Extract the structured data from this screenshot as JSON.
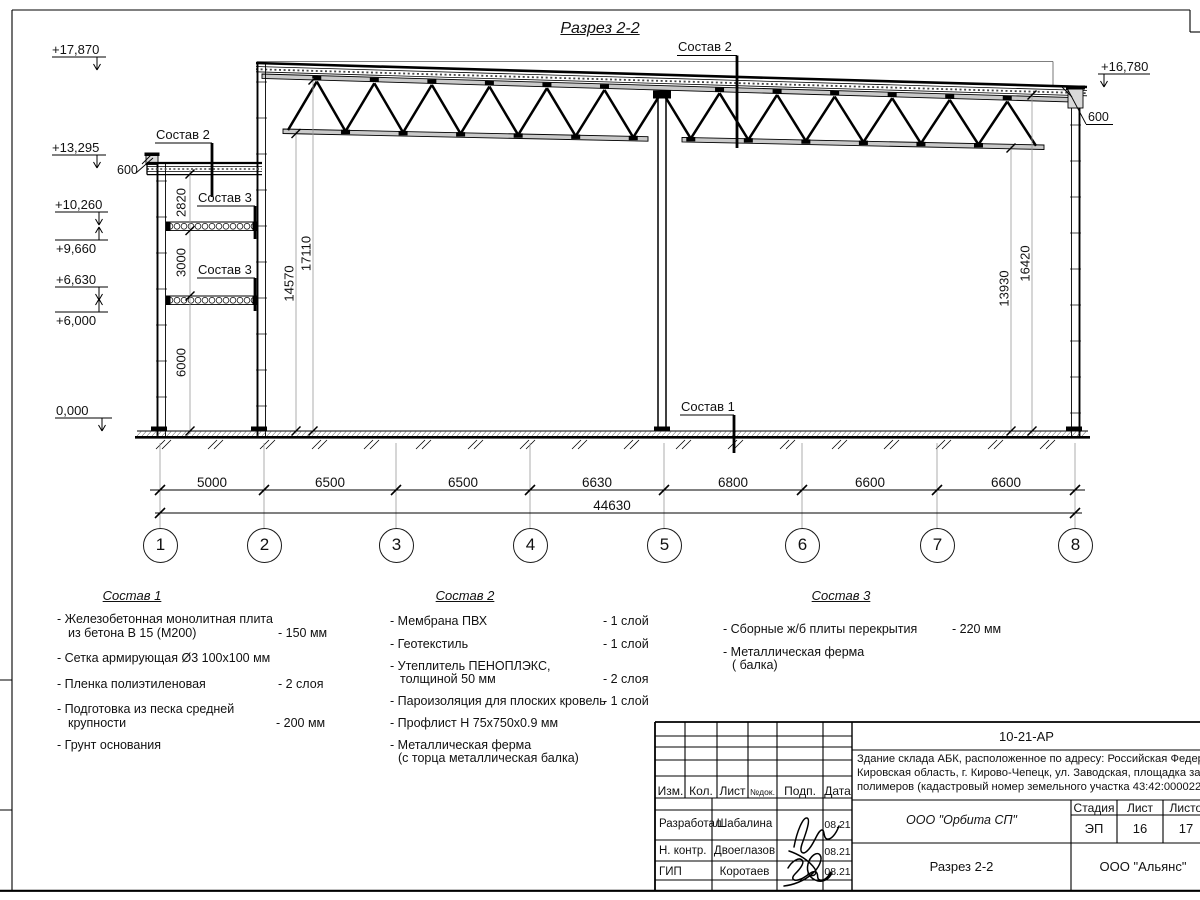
{
  "drawing": {
    "title": "Разрез 2-2",
    "callout_sostav_1": "Состав 1",
    "callout_sostav_2": "Состав 2",
    "callout_sostav_3": "Состав 3",
    "elevations": {
      "top_left": "+17,870",
      "annex_parapet": "+13,295",
      "level_10260": "+10,260",
      "level_9660": "+9,660",
      "level_6630": "+6,630",
      "level_6000": "+6,000",
      "ground": "0,000",
      "top_right": "+16,780"
    },
    "dims": {
      "parapet_left": "600",
      "parapet_right": "600",
      "annex_2820": "2820",
      "annex_3000": "3000",
      "annex_6000": "6000",
      "hall_left_clear": "14570",
      "hall_left_total": "17110",
      "hall_right_clear": "13930",
      "hall_right_total": "16420",
      "spans": [
        "5000",
        "6500",
        "6500",
        "6630",
        "6800",
        "6600",
        "6600"
      ],
      "total": "44630"
    },
    "axes": [
      "1",
      "2",
      "3",
      "4",
      "5",
      "6",
      "7",
      "8"
    ]
  },
  "legend_1": {
    "title": "Состав 1",
    "items": [
      {
        "t": "- Железобетонная  монолитная плита",
        "t2": "из бетона В 15 (М200)",
        "v": "- 150 мм"
      },
      {
        "t": "- Сетка армирующая Ø3 100х100 мм",
        "t2": "",
        "v": ""
      },
      {
        "t": "- Пленка полиэтиленовая",
        "t2": "",
        "v": "-  2 слоя"
      },
      {
        "t": "- Подготовка из песка средней",
        "t2": "крупности",
        "v": "- 200 мм"
      },
      {
        "t": "- Грунт основания",
        "t2": "",
        "v": ""
      }
    ]
  },
  "legend_2": {
    "title": "Состав 2",
    "items": [
      {
        "t": "- Мембрана ПВХ",
        "t2": "",
        "v": "- 1 слой"
      },
      {
        "t": "- Геотекстиль",
        "t2": "",
        "v": "- 1 слой"
      },
      {
        "t": "- Утеплитель ПЕНОПЛЭКС,",
        "t2": "толщиной 50 мм",
        "v": "- 2 слоя"
      },
      {
        "t": "- Пароизоляция для плоских кровель",
        "t2": "",
        "v": "- 1 слой"
      },
      {
        "t": "- Профлист Н 75х750х0.9 мм",
        "t2": "",
        "v": ""
      },
      {
        "t": "- Металлическая ферма",
        "t2": "(с торца металлическая балка)",
        "v": ""
      }
    ]
  },
  "legend_3": {
    "title": "Состав 3",
    "items": [
      {
        "t": "- Сборные ж/б плиты перекрытия",
        "t2": "",
        "v": "- 220 мм"
      },
      {
        "t": "- Металлическая ферма",
        "t2": "( балка)",
        "v": ""
      }
    ]
  },
  "titleblock": {
    "code": "10-21-АР",
    "object_line_1": "Здание склада АБК, расположенное по адресу: Российская Федерация,",
    "object_line_2": "Кировская область, г. Кирово-Чепецк, ул. Заводская, площадка завода",
    "object_line_3": "полимеров (кадастровый номер земельного участка 43:42:000022:",
    "col_izm": "Изм.",
    "col_kol": "Кол.",
    "col_list": "Лист",
    "col_ndok": "№док.",
    "col_podp": "Подп.",
    "col_data": "Дата",
    "rows": [
      {
        "role": "Разработал",
        "name": "Шабалина",
        "date": "08.21"
      },
      {
        "role": "Н. контр.",
        "name": "Двоеглазов",
        "date": "08.21"
      },
      {
        "role": "ГИП",
        "name": "Коротаев",
        "date": "08.21"
      }
    ],
    "org": "ООО \"Орбита СП\"",
    "stage_label": "Стадия",
    "sheet_label": "Лист",
    "sheets_label": "Листов",
    "stage": "ЭП",
    "sheet": "16",
    "sheets": "17",
    "section_name": "Разрез 2-2",
    "firm": "ООО \"Альянс\""
  }
}
